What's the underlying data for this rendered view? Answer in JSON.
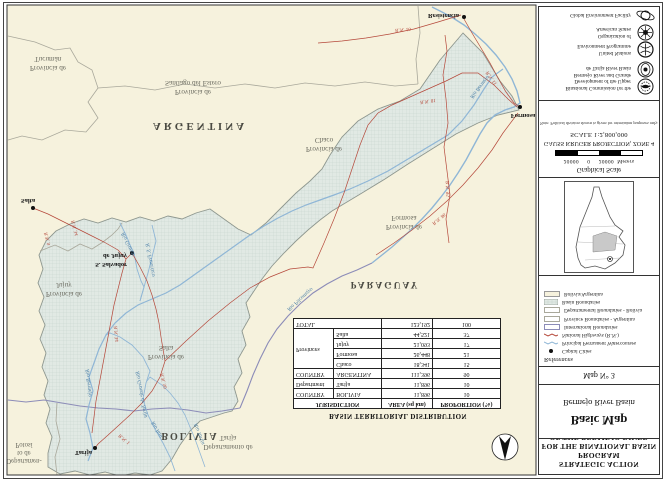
{
  "program_title": {
    "line1": "STRATEGIC ACTION PROGRAM",
    "line2": "FOR THE BINATIONAL BASIN",
    "line3": "OF THE BERMEJO RIVER"
  },
  "map_title": {
    "main": "Basic Map",
    "sub": "Bermejo River Basin",
    "map_no": "Map N° 3"
  },
  "legend": {
    "heading": "References",
    "items": [
      {
        "label": "Capital Cities",
        "swatch": "capital-dot"
      },
      {
        "label": "Principal Permanent Watercourses",
        "swatch": "river-line"
      },
      {
        "label": "National Highways (R.N.)",
        "swatch": "highway-line"
      },
      {
        "label": "International Boundaries",
        "swatch": "intl-boundary"
      },
      {
        "label": "Province Boundaries - Argentina",
        "swatch": "province-boundary"
      },
      {
        "label": "Departamental Boundaries - Bolivia",
        "swatch": "dept-boundary"
      },
      {
        "label": "Basin Boundaries",
        "swatch": "basin-hatch"
      },
      {
        "label": "Bolivia/Argentina",
        "swatch": "country-fill"
      }
    ]
  },
  "scale_block": {
    "heading": "Graphical Scale",
    "left_num": "20000",
    "zero": "0",
    "right_num": "20000",
    "unit": "Meters",
    "projection": "GAUSS KRUGER PROJECTION, ZONE 4",
    "scale_text": "SCALE 1:2,800,000",
    "note": "Note: Political division shown is given for orientation purposes only."
  },
  "credits": [
    {
      "name": "binational-commission",
      "lines": [
        "Binational Commission for the",
        "Development of the Upper",
        "Bermejo River and Grande",
        "de Tarija River Basin"
      ]
    },
    {
      "name": "unep",
      "lines": [
        "United Nations",
        "Environment Programme"
      ]
    },
    {
      "name": "oas",
      "lines": [
        "Organization of",
        "American States"
      ]
    },
    {
      "name": "gef",
      "lines": [
        "Global Environment Facility"
      ]
    }
  ],
  "table": {
    "title": "BASIN TERRITORIAL DISTRIBUTION",
    "headers": {
      "jurisdiction": "JURISDICTION",
      "area": "AREA (sq km)",
      "proportion": "PROPORTION (%)"
    },
    "rows": [
      {
        "level": "COUNTRY",
        "name": "BOLIVIA",
        "area": "11,896",
        "prop": "10"
      },
      {
        "level": "Department",
        "name": "Tarija",
        "area": "11,896",
        "prop": "10"
      },
      {
        "level": "COUNTRY",
        "name": "ARGENTINA",
        "area": "111,396",
        "prop": "90"
      },
      {
        "level": "Provinces",
        "name": "Chaco",
        "area": "18,341",
        "prop": "15"
      },
      {
        "level": "",
        "name": "Formosa",
        "area": "26,448",
        "prop": "21"
      },
      {
        "level": "",
        "name": "Jujuy",
        "area": "21,093",
        "prop": "17"
      },
      {
        "level": "",
        "name": "Salta",
        "area": "44,521",
        "prop": "37"
      },
      {
        "level": "TOTAL",
        "name": "",
        "area": "123,192",
        "prop": "100"
      }
    ]
  },
  "map": {
    "countries": {
      "argentina": "ARGENTINA",
      "bolivia": "BOLIVIA",
      "paraguay": "PARAGUAY"
    },
    "regions": {
      "tucuman1": "Provincia de",
      "tucuman2": "Tucumán",
      "santiago1": "Provincia de",
      "santiago2": "Santiago del Estero",
      "chaco1": "Provincia de",
      "chaco2": "Chaco",
      "formosa1": "Provincia de",
      "formosa2": "Formosa",
      "salta1": "Provincia de",
      "salta2": "Salta",
      "jujuy1": "Provincia de",
      "jujuy2": "Jujuy",
      "tarija1": "Departamento de",
      "tarija2": "Tarija",
      "potosi1": "Departamen-",
      "potosi2": "to de",
      "potosi3": "Potosí"
    },
    "cities": {
      "salta": "Salta",
      "jujuy1": "S. Salvador",
      "jujuy2": "de Jujuy",
      "tarija": "Tarija",
      "formosa": "Formosa",
      "resistencia": "Resistencia"
    },
    "rivers": {
      "bermejo_upper": "Rio Bermejo",
      "bermejo_lower": "Rio Bermejo",
      "grande": "Rio Grande",
      "san_francisco": "R. S. Francisco",
      "tarija": "Rio Tarija",
      "itau": "Rio Itau",
      "grande_tarija": "Rio Grande de Tarija",
      "pilcomayo": "Rio Pilcomayo"
    },
    "highways": {
      "rn9": "R.N. 9",
      "rn34a": "R.N. 34",
      "rn34b": "R.N. 34",
      "rn50": "R.N. 50",
      "rn1": "R.N. 1",
      "rn81": "R.N. 81",
      "rn86": "R.N. 86",
      "rn95": "R.N. 95",
      "rn11": "R.N. 11",
      "rn16": "R.N. 16"
    }
  },
  "colors": {
    "land_cream": "#f6f2dd",
    "basin_fill": "#e1e9e4",
    "basin_grid": "#c6d3cc",
    "basin_edge": "#8e978f",
    "gray_boundary": "#a9a89b",
    "intl_boundary": "#8c8cb8",
    "river_blue": "#8fb6d6",
    "highway_red": "#b5483a",
    "frame": "#333333"
  }
}
